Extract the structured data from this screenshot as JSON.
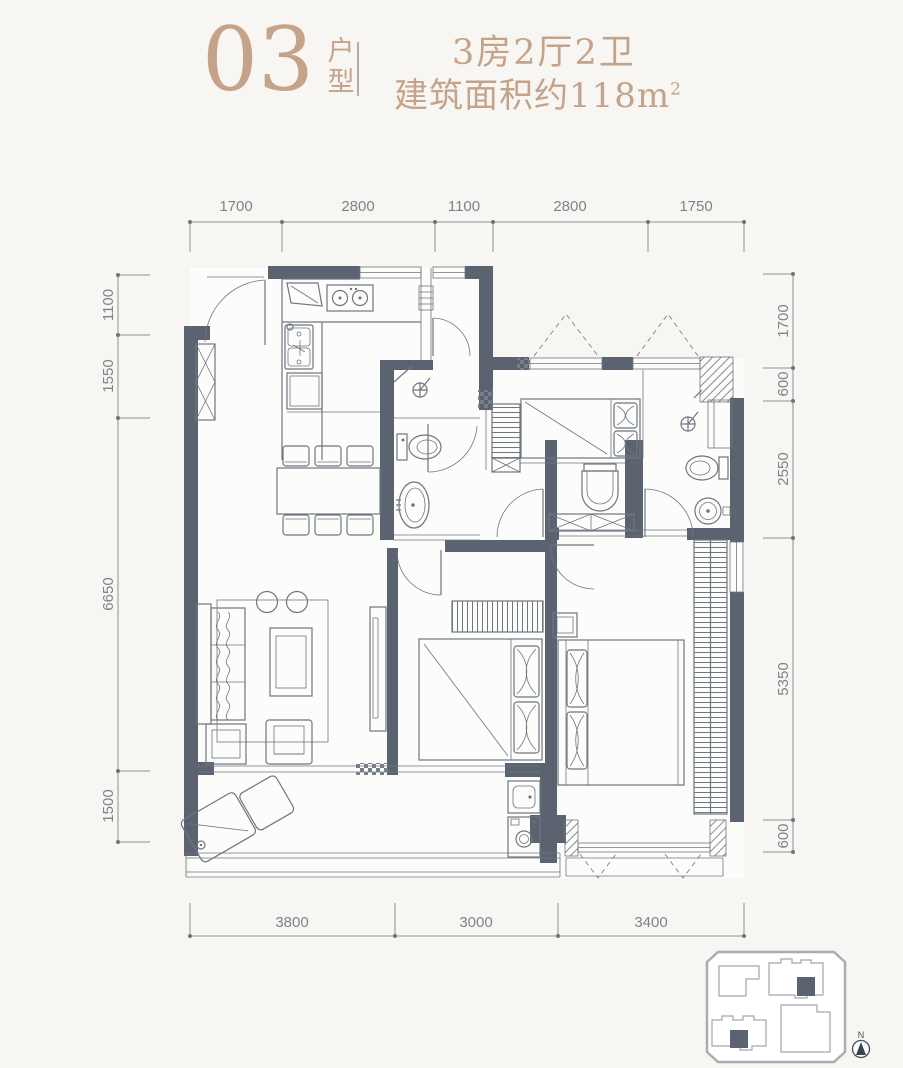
{
  "header": {
    "unit_number": "03",
    "unit_type_label": "户型",
    "spec_line": "3房2厅2卫",
    "area_line": "建筑面积约118m",
    "area_superscript": "2"
  },
  "dimensions": {
    "top": [
      "1700",
      "2800",
      "1100",
      "2800",
      "1750"
    ],
    "left": [
      "1100",
      "1550",
      "6650",
      "1500"
    ],
    "right": [
      "1700",
      "600",
      "2550",
      "5350",
      "600"
    ],
    "bottom": [
      "3800",
      "3000",
      "3400"
    ]
  },
  "compass": {
    "north_label": "N"
  },
  "plan": {
    "rooms": [
      "entry",
      "kitchen",
      "dining-room",
      "living-room",
      "balcony",
      "bathroom-1",
      "bedroom-2",
      "bedroom-3",
      "master-bedroom",
      "master-bathroom",
      "laundry-niche"
    ],
    "furniture": [
      "stove",
      "kitchen-sink",
      "fridge-cabinet",
      "dining-table",
      "dining-chairs",
      "sofa",
      "coffee-table",
      "round-stools",
      "armchair",
      "side-table",
      "tv-cabinet",
      "lounge-chair",
      "laundry-sink",
      "washing-machine",
      "beds",
      "wardrobes",
      "toilets",
      "wash-basins",
      "shower-heads",
      "shoe-cabinet"
    ]
  },
  "colors": {
    "accent": "#c5a28a",
    "wall": "#5b6370",
    "line": "#6e7681",
    "dimension": "#7d838b",
    "background": "#f7f6f3",
    "floor": "#fcfcfb",
    "keymap_unit": "#5b6370"
  }
}
